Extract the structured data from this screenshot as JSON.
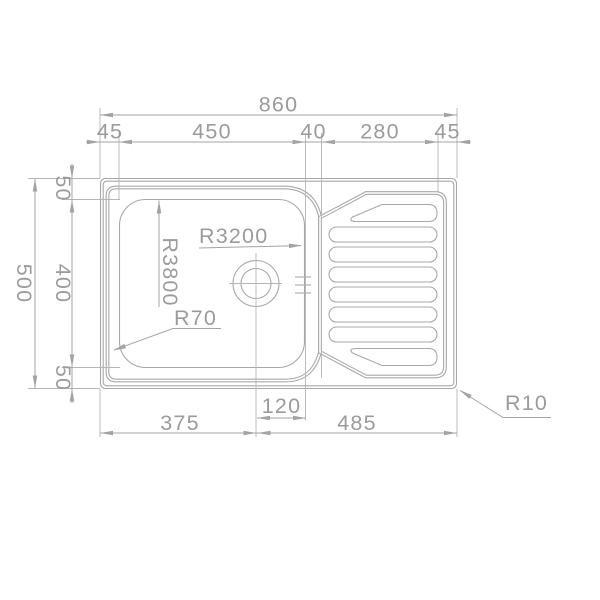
{
  "drawing_type": "sink-top-view-dimensioned-drawing",
  "colors": {
    "background": "#ffffff",
    "outline": "#a8a8a8",
    "dimension_lines": "#a3a3a3",
    "extension_lines": "#b5b5b5",
    "text": "#9b9b9b"
  },
  "dimensions": {
    "top": {
      "total": "860",
      "segments": [
        "45",
        "450",
        "40",
        "280",
        "45"
      ]
    },
    "left": {
      "total": "500",
      "segments": [
        "50",
        "400",
        "50"
      ]
    },
    "bottom": {
      "segments": [
        "375",
        "120",
        "485"
      ]
    }
  },
  "radii": {
    "r3200": "R3200",
    "r3800": "R3800",
    "r70": "R70",
    "r10": "R10"
  }
}
